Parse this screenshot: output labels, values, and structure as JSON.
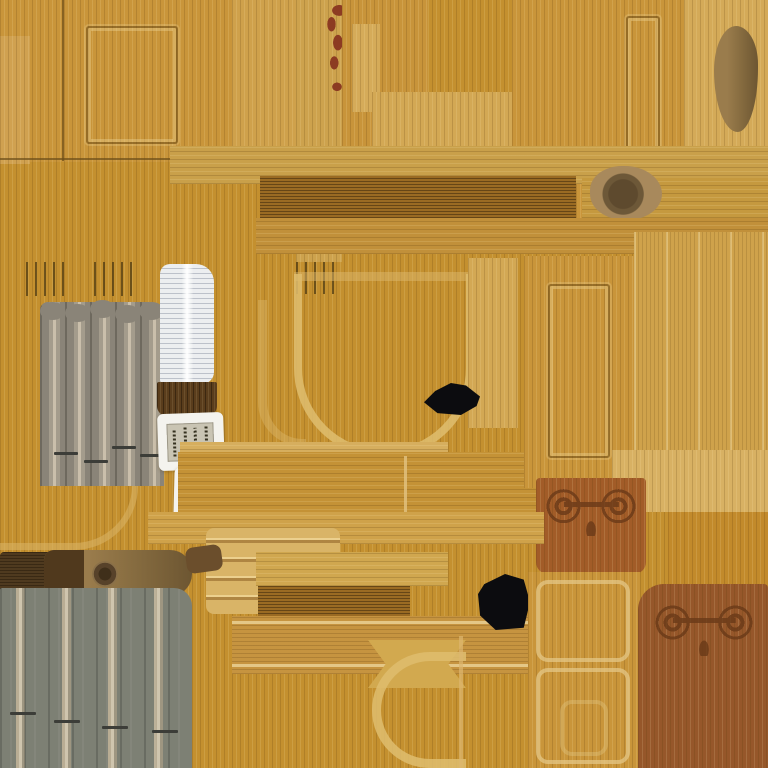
{
  "meta": {
    "description": "wood-furniture texture atlas sheet",
    "canvas_width": 768,
    "canvas_height": 768,
    "visible_text": ""
  },
  "palette": {
    "base_wood": "#c4902f",
    "door_wood": "#c9953a",
    "light_tan": "#d8b164",
    "pale_outline": "#dcb76d",
    "dark_beam": "#9a6b23",
    "seam": "#6b4d18",
    "gray_pipes": "#8a8478",
    "gray_wall": "#7d8074",
    "ridge_highlight": "#cfc5ae",
    "page_white": "#eceef0",
    "paper_white": "#f4f3ee",
    "paper_panel": "#c9c4b3",
    "script_ink": "#35311f",
    "book_cover": "#5a3d1c",
    "black_patch": "#0c0c0f",
    "red_carving": "#8c3b22",
    "ornament_panel": "#a25c28",
    "ornament_dark": "#6a3a18",
    "bottom_right_panel": "#96572a",
    "log_brown": "#7b5c36",
    "oak_plank": "#c28a2b"
  },
  "regions": [
    {
      "n": "base-wood",
      "x": 0,
      "y": 0,
      "w": 768,
      "h": 768,
      "s": "wv",
      "c": "#c4902f"
    },
    {
      "n": "cabinet-door-panel",
      "x": 0,
      "y": 0,
      "w": 232,
      "h": 162,
      "s": "wv",
      "c": "#c9953a"
    },
    {
      "n": "cabinet-door-left-stile",
      "x": 0,
      "y": 36,
      "w": 30,
      "h": 128,
      "s": "wv",
      "c": "#d0a150"
    },
    {
      "n": "cabinet-door-seam-vertical",
      "x": 62,
      "y": 0,
      "w": 2,
      "h": 161,
      "s": "flat",
      "c": "#6b4d18",
      "o": 0.7
    },
    {
      "n": "cabinet-door-inset-frame",
      "x": 86,
      "y": 26,
      "w": 92,
      "h": 118,
      "s": "groove"
    },
    {
      "n": "cabinet-door-seam-horizontal",
      "x": 0,
      "y": 158,
      "w": 236,
      "h": 2,
      "s": "flat",
      "c": "#6b4d18",
      "o": 0.7
    },
    {
      "n": "top-middle-tan-strip",
      "x": 232,
      "y": 0,
      "w": 64,
      "h": 182,
      "s": "wv",
      "c": "#cfa14b"
    },
    {
      "n": "carving-backing-strip",
      "x": 296,
      "y": 0,
      "w": 46,
      "h": 262,
      "s": "wv",
      "c": "#cda24d"
    },
    {
      "n": "red-floral-carving",
      "x": 314,
      "y": 4,
      "w": 46,
      "h": 92,
      "s": "carving"
    },
    {
      "n": "top-middle-wood-panel",
      "x": 342,
      "y": 0,
      "w": 86,
      "h": 188,
      "s": "wv",
      "c": "#c8943a"
    },
    {
      "n": "top-middle-tan-patch",
      "x": 352,
      "y": 24,
      "w": 28,
      "h": 88,
      "s": "wv",
      "c": "#d5ab59"
    },
    {
      "n": "top-middle-wide-tan-patch",
      "x": 372,
      "y": 92,
      "w": 140,
      "h": 90,
      "s": "wv",
      "c": "#d3a854"
    },
    {
      "n": "top-right-door-panel",
      "x": 512,
      "y": 0,
      "w": 172,
      "h": 232,
      "s": "wv",
      "c": "#c9953a"
    },
    {
      "n": "top-right-slot-frame",
      "x": 626,
      "y": 16,
      "w": 34,
      "h": 146,
      "s": "groove"
    },
    {
      "n": "top-right-tan-corner",
      "x": 684,
      "y": 0,
      "w": 84,
      "h": 186,
      "s": "wv",
      "c": "#d4aa58"
    },
    {
      "n": "log-end-crescent",
      "x": 714,
      "y": 26,
      "w": 44,
      "h": 106,
      "s": "log-face",
      "r": "50% 50% 46% 54% / 42% 36% 60% 58%"
    },
    {
      "n": "middle-beam-light",
      "x": 170,
      "y": 146,
      "w": 598,
      "h": 38,
      "s": "wh",
      "c": "#c9a04a"
    },
    {
      "n": "middle-beam-dark",
      "x": 260,
      "y": 176,
      "w": 316,
      "h": 42,
      "s": "wh-dark",
      "c": "#9a6b23"
    },
    {
      "n": "middle-beam-right",
      "x": 582,
      "y": 178,
      "w": 186,
      "h": 40,
      "s": "wh",
      "c": "#c5993f"
    },
    {
      "n": "beam-log-knot",
      "x": 590,
      "y": 166,
      "w": 72,
      "h": 54,
      "s": "knot-big"
    },
    {
      "n": "middle-slat-band",
      "x": 256,
      "y": 218,
      "w": 512,
      "h": 36,
      "s": "wh",
      "c": "#c1903a"
    },
    {
      "n": "hinge-ticks-left",
      "x": 26,
      "y": 262,
      "w": 40,
      "h": 34,
      "s": "ticks"
    },
    {
      "n": "hinge-ticks-mid",
      "x": 94,
      "y": 262,
      "w": 38,
      "h": 34,
      "s": "ticks"
    },
    {
      "n": "hinge-ticks-right",
      "x": 296,
      "y": 262,
      "w": 42,
      "h": 32,
      "s": "ticks"
    },
    {
      "n": "left-pale-corner-outline",
      "x": 0,
      "y": 432,
      "w": 138,
      "h": 118,
      "s": "band-corner"
    },
    {
      "n": "mid-left-pale-outline",
      "x": 258,
      "y": 300,
      "w": 48,
      "h": 146,
      "s": "band-left"
    },
    {
      "n": "organ-pipes",
      "x": 40,
      "y": 302,
      "w": 124,
      "h": 184,
      "s": "pipes",
      "deco": [
        {
          "k": "scallops",
          "x": 0,
          "y": 0,
          "w": 25,
          "h": 18
        },
        {
          "k": "tickmark",
          "x": 14,
          "y": 150,
          "w": 24,
          "h": 3
        },
        {
          "k": "tickmark",
          "x": 44,
          "y": 158,
          "w": 24,
          "h": 3
        },
        {
          "k": "tickmark",
          "x": 72,
          "y": 144,
          "w": 24,
          "h": 3
        },
        {
          "k": "tickmark",
          "x": 100,
          "y": 152,
          "w": 24,
          "h": 3
        }
      ]
    },
    {
      "n": "book-page-stack",
      "x": 160,
      "y": 264,
      "w": 54,
      "h": 120,
      "s": "pages",
      "r": "10px 18px 12px 4px"
    },
    {
      "n": "book-cover-block",
      "x": 157,
      "y": 382,
      "w": 60,
      "h": 34,
      "s": "wv-dark",
      "c": "#5a3d1c",
      "r": "2px 2px 10px 10px"
    },
    {
      "n": "script-paper-top",
      "x": 158,
      "y": 413,
      "w": 66,
      "h": 57,
      "s": "paper",
      "rot": -2,
      "deco": [
        {
          "k": "glyphs",
          "x": 9,
          "y": 10,
          "w": 47,
          "h": 38
        }
      ]
    },
    {
      "n": "script-paper-bottom",
      "x": 174,
      "y": 468,
      "w": 64,
      "h": 51,
      "s": "paper",
      "rot": 1.5,
      "deco": [
        {
          "k": "glyphs",
          "x": 8,
          "y": 9,
          "w": 47,
          "h": 34
        }
      ]
    },
    {
      "n": "seat-u-outline-top-band",
      "x": 294,
      "y": 272,
      "w": 180,
      "h": 9,
      "s": "flat",
      "c": "#dcb76d",
      "o": 0.5
    },
    {
      "n": "seat-u-outline",
      "x": 294,
      "y": 274,
      "w": 180,
      "h": 184,
      "s": "uband"
    },
    {
      "n": "right-of-u-tan-strip",
      "x": 468,
      "y": 258,
      "w": 50,
      "h": 170,
      "s": "wv",
      "c": "#d3a854"
    },
    {
      "n": "black-patch-upper",
      "x": 424,
      "y": 383,
      "w": 56,
      "h": 32,
      "s": "black",
      "cl": "polygon(0 60%, 20% 25%, 48% 0, 75% 8%, 100% 42%, 94% 72%, 66% 100%, 24% 94%)"
    },
    {
      "n": "plank-row-tan-edge",
      "x": 180,
      "y": 442,
      "w": 268,
      "h": 16,
      "s": "wh",
      "c": "#d6ae5e"
    },
    {
      "n": "plank-row",
      "x": 178,
      "y": 452,
      "w": 462,
      "h": 70,
      "s": "wh",
      "c": "#c49236"
    },
    {
      "n": "plank-separator-1",
      "x": 404,
      "y": 456,
      "w": 3,
      "h": 62,
      "s": "flat",
      "c": "#e2c382",
      "o": 0.8
    },
    {
      "n": "plank-separator-2",
      "x": 560,
      "y": 470,
      "w": 3,
      "h": 48,
      "s": "flat",
      "c": "#e2c382",
      "o": 0.5
    },
    {
      "n": "right-door-slab",
      "x": 524,
      "y": 256,
      "w": 110,
      "h": 232,
      "s": "wv",
      "c": "#c9953a"
    },
    {
      "n": "right-door-inset-frame",
      "x": 548,
      "y": 284,
      "w": 62,
      "h": 174,
      "s": "groove"
    },
    {
      "n": "right-light-planks",
      "x": 634,
      "y": 232,
      "w": 134,
      "h": 280,
      "s": "wv-planks",
      "c": "#cfa24b"
    },
    {
      "n": "right-tan-patch",
      "x": 612,
      "y": 450,
      "w": 156,
      "h": 62,
      "s": "wv",
      "c": "#d8b163"
    },
    {
      "n": "mid-ornament-panel",
      "x": 536,
      "y": 478,
      "w": 110,
      "h": 96,
      "s": "wv",
      "c": "#a25c28",
      "r": "4px 4px 12px 12px",
      "deco": [
        {
          "k": "scrolls",
          "x": 6,
          "y": 10,
          "w": 98,
          "h": 48
        }
      ]
    },
    {
      "n": "oak-plank-block",
      "x": 668,
      "y": 512,
      "w": 100,
      "h": 78,
      "s": "wv",
      "c": "#c28a2b"
    },
    {
      "n": "bottom-left-cross-beam",
      "x": 148,
      "y": 512,
      "w": 396,
      "h": 32,
      "s": "wh",
      "c": "#cfa24a"
    },
    {
      "n": "slat-crate-panel",
      "x": 206,
      "y": 528,
      "w": 134,
      "h": 86,
      "s": "slats"
    },
    {
      "n": "dark-log-left",
      "x": 0,
      "y": 552,
      "w": 68,
      "h": 46,
      "s": "wh-dark",
      "c": "#4f3a1f",
      "r": "4px 18px 18px 6px"
    },
    {
      "n": "carved-log",
      "x": 44,
      "y": 550,
      "w": 148,
      "h": 46,
      "s": "log-face",
      "r": "10px 22px 22px 10px",
      "deco": [
        {
          "k": "cap",
          "x": 0,
          "y": 0,
          "w": 40,
          "h": 46
        },
        {
          "k": "knot",
          "x": 48,
          "y": 11,
          "w": 26,
          "h": 26
        }
      ]
    },
    {
      "n": "log-small-piece",
      "x": 186,
      "y": 546,
      "w": 36,
      "h": 26,
      "s": "flat",
      "c": "#6b4e2c",
      "r": "8px",
      "rot": -8
    },
    {
      "n": "gray-wall-panel",
      "x": 0,
      "y": 588,
      "w": 192,
      "h": 180,
      "s": "graywall",
      "deco": [
        {
          "k": "tickmark",
          "x": 10,
          "y": 124,
          "w": 26,
          "h": 3
        },
        {
          "k": "tickmark",
          "x": 54,
          "y": 132,
          "w": 26,
          "h": 3
        },
        {
          "k": "tickmark",
          "x": 102,
          "y": 138,
          "w": 26,
          "h": 3
        },
        {
          "k": "tickmark",
          "x": 152,
          "y": 142,
          "w": 26,
          "h": 3
        }
      ]
    },
    {
      "n": "bottom-mid-beam-a",
      "x": 256,
      "y": 552,
      "w": 192,
      "h": 34,
      "s": "wh",
      "c": "#d0a74f"
    },
    {
      "n": "bottom-mid-dark-slats",
      "x": 258,
      "y": 586,
      "w": 152,
      "h": 58,
      "s": "wh-dark",
      "c": "#9a6b23"
    },
    {
      "n": "bottom-mid-beam-b",
      "x": 232,
      "y": 616,
      "w": 448,
      "h": 58,
      "s": "wh-pale",
      "c": "#c69440"
    },
    {
      "n": "spool-piece",
      "x": 368,
      "y": 640,
      "w": 98,
      "h": 48,
      "s": "flat",
      "c": "#d2a94f",
      "cl": "polygon(0 0, 100% 0, 82% 50%, 100% 100%, 0 100%, 18% 50%)"
    },
    {
      "n": "c-outline-band",
      "x": 372,
      "y": 652,
      "w": 94,
      "h": 116,
      "s": "cband"
    },
    {
      "n": "pale-divider",
      "x": 459,
      "y": 636,
      "w": 4,
      "h": 132,
      "s": "flat",
      "c": "#ddb76f",
      "o": 0.7
    },
    {
      "n": "black-patch-lower",
      "x": 478,
      "y": 574,
      "w": 52,
      "h": 56,
      "s": "black",
      "cl": "polygon(12% 18%, 52% 0, 88% 10%, 100% 50%, 88% 96%, 34% 100%, 4% 74%, 0 36%)"
    },
    {
      "n": "bottom-right-left-wood",
      "x": 528,
      "y": 572,
      "w": 112,
      "h": 196,
      "s": "wv",
      "c": "#c9953a"
    },
    {
      "n": "bottom-right-outline-upper",
      "x": 536,
      "y": 580,
      "w": 94,
      "h": 82,
      "s": "pale-rect"
    },
    {
      "n": "bottom-right-outline-lower",
      "x": 536,
      "y": 668,
      "w": 94,
      "h": 96,
      "s": "pale-rect"
    },
    {
      "n": "bottom-right-outline-inner",
      "x": 560,
      "y": 700,
      "w": 48,
      "h": 56,
      "s": "pale-rect",
      "o": 0.5
    },
    {
      "n": "bottom-right-ornament-panel",
      "x": 638,
      "y": 584,
      "w": 130,
      "h": 184,
      "s": "wv",
      "c": "#96572a",
      "r": "26px 4px 0 0",
      "deco": [
        {
          "k": "scrolls",
          "x": 10,
          "y": 18,
          "w": 112,
          "h": 54
        }
      ]
    }
  ]
}
